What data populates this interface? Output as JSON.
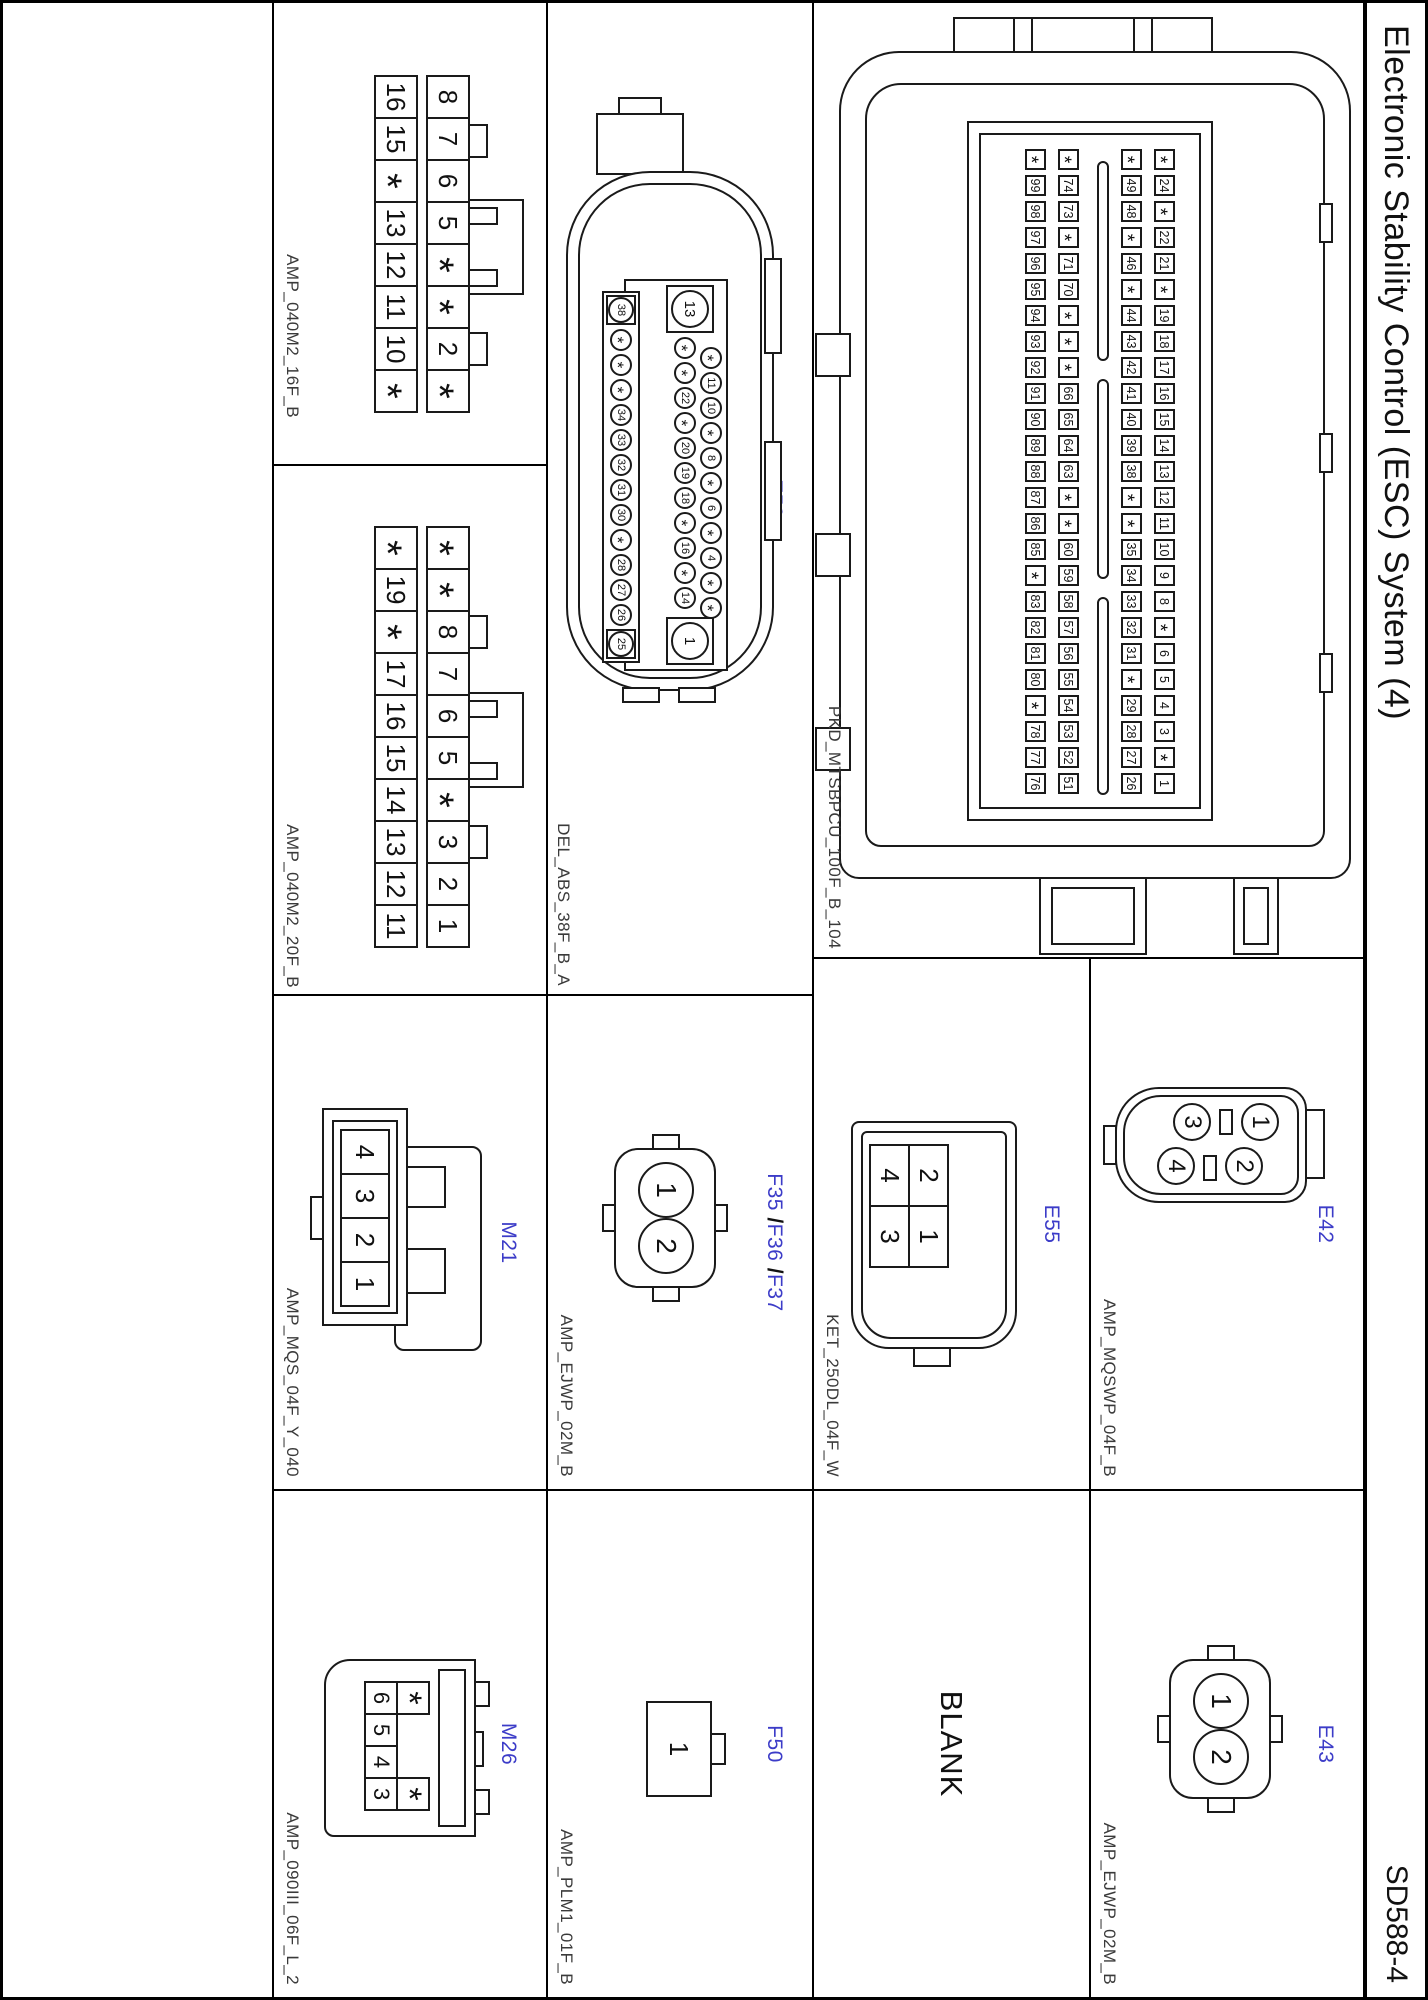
{
  "header": {
    "title": "Electronic Stability Control (ESC) System (4)",
    "code": "SD588-4"
  },
  "colors": {
    "accent": "#3c3cc8",
    "line": "#1a1a1a",
    "background": "#ffffff"
  },
  "cells": {
    "clgb": {
      "name": "CLG-B",
      "part": "PKD_MTSBPCU_100F_B_104",
      "rows": [
        [
          "*",
          "24",
          "*",
          "22",
          "21",
          "*",
          "19",
          "18",
          "17",
          "16",
          "15",
          "14",
          "13",
          "12",
          "11",
          "10",
          "9",
          "8",
          "*",
          "6",
          "5",
          "4",
          "3",
          "*",
          "1"
        ],
        [
          "*",
          "49",
          "48",
          "*",
          "46",
          "*",
          "44",
          "43",
          "42",
          "41",
          "40",
          "39",
          "38",
          "*",
          "*",
          "35",
          "34",
          "33",
          "32",
          "31",
          "*",
          "29",
          "28",
          "27",
          "26"
        ],
        [
          "*",
          "74",
          "73",
          "*",
          "71",
          "70",
          "*",
          "*",
          "*",
          "66",
          "65",
          "64",
          "63",
          "*",
          "*",
          "60",
          "59",
          "58",
          "57",
          "56",
          "55",
          "54",
          "53",
          "52",
          "51"
        ],
        [
          "*",
          "99",
          "98",
          "97",
          "96",
          "95",
          "94",
          "93",
          "92",
          "91",
          "90",
          "89",
          "88",
          "87",
          "86",
          "85",
          "*",
          "83",
          "82",
          "81",
          "80",
          "*",
          "78",
          "77",
          "76"
        ]
      ]
    },
    "e42": {
      "name": "E42",
      "part": "AMP_MQSWP_04F_B",
      "pins": [
        "1",
        "2",
        "3",
        "4"
      ]
    },
    "e43": {
      "name": "E43",
      "part": "AMP_EJWP_02M_B",
      "pins": [
        "1",
        "2"
      ]
    },
    "e55": {
      "name": "E55",
      "part": "KET_250DL_04F_W",
      "row_top": [
        "2",
        "1"
      ],
      "row_bottom": [
        "4",
        "3"
      ]
    },
    "blank": {
      "label": "BLANK"
    },
    "e59": {
      "name": "E59",
      "part": "DEL_ABS_38F_B_A",
      "row1": [
        "*",
        "11",
        "10",
        "*",
        "8",
        "*",
        "6",
        "*",
        "4",
        "*",
        "*"
      ],
      "big13": "13",
      "row2": [
        "*",
        "*",
        "22",
        "*",
        "20",
        "19",
        "18",
        "*",
        "16",
        "*",
        "14"
      ],
      "big1": "1",
      "big38": "38",
      "row3": [
        "*",
        "*",
        "*",
        "34",
        "33",
        "32",
        "31",
        "30",
        "*",
        "28",
        "27",
        "26"
      ],
      "big25": "25"
    },
    "f35": {
      "names": [
        "F35",
        "F36",
        "F37"
      ],
      "separator": "/",
      "part": "AMP_EJWP_02M_B",
      "pins": [
        "1",
        "2"
      ]
    },
    "f50": {
      "name": "F50",
      "part": "AMP_PLM1_01F_B",
      "pins": [
        "1"
      ]
    },
    "m04a": {
      "name": "M04-A",
      "part": "AMP_040M2_16F_B",
      "row_top": [
        "8",
        "7",
        "6",
        "5",
        "*",
        "*",
        "2",
        "*"
      ],
      "row_bottom": [
        "16",
        "15",
        "*",
        "13",
        "12",
        "11",
        "10",
        "*"
      ]
    },
    "m04b": {
      "name": "M04-B",
      "part": "AMP_040M2_20F_B",
      "row_top": [
        "*",
        "*",
        "8",
        "7",
        "6",
        "5",
        "*",
        "3",
        "2",
        "1"
      ],
      "row_bottom": [
        "*",
        "19",
        "*",
        "17",
        "16",
        "15",
        "14",
        "13",
        "12",
        "11"
      ]
    },
    "m21": {
      "name": "M21",
      "part": "AMP_MQS_04F_Y_040",
      "pins": [
        "4",
        "3",
        "2",
        "1"
      ]
    },
    "m26": {
      "name": "M26",
      "part": "AMP_090III_06F_L_2",
      "star_left": "*",
      "star_right": "*",
      "row": [
        "6",
        "5",
        "4",
        "3"
      ]
    }
  }
}
